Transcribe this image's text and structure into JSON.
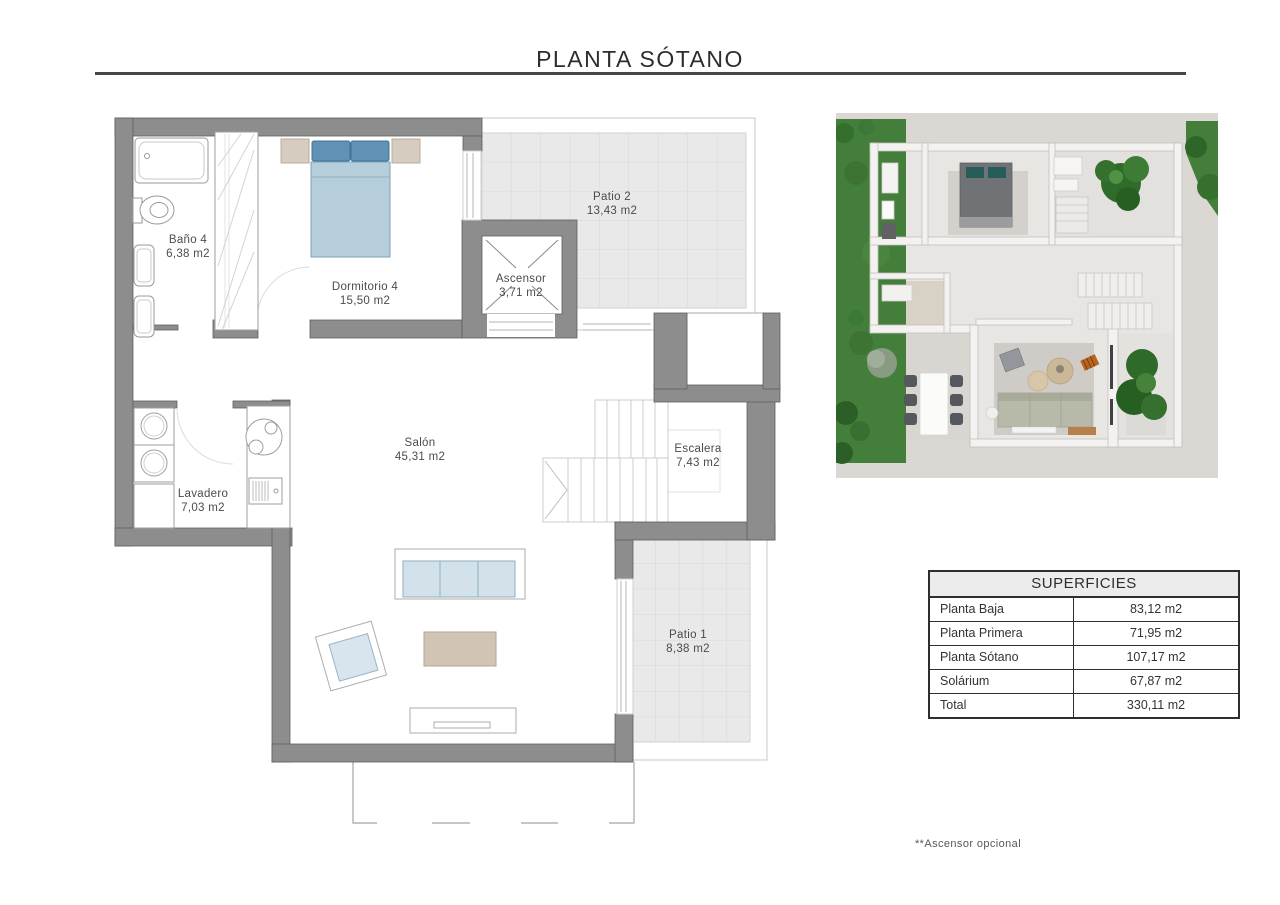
{
  "title": "PLANTA SÓTANO",
  "floor_plan": {
    "rooms": [
      {
        "name": "Baño 4",
        "area": "6,38 m2"
      },
      {
        "name": "Dormitorio 4",
        "area": "15,50 m2"
      },
      {
        "name": "Ascensor",
        "area": "3,71 m2"
      },
      {
        "name": "Patio 2",
        "area": "13,43 m2"
      },
      {
        "name": "Salón",
        "area": "45,31 m2"
      },
      {
        "name": "Escalera",
        "area": "7,43 m2"
      },
      {
        "name": "Lavadero",
        "area": "7,03 m2"
      },
      {
        "name": "Patio 1",
        "area": "8,38 m2"
      }
    ]
  },
  "table": {
    "header": "SUPERFICIES",
    "rows": [
      {
        "label": "Planta Baja",
        "value": "83,12 m2"
      },
      {
        "label": "Planta Primera",
        "value": "71,95 m2"
      },
      {
        "label": "Planta Sótano",
        "value": "107,17 m2"
      },
      {
        "label": "Solárium",
        "value": "67,87 m2"
      },
      {
        "label": "Total",
        "value": "330,11 m2"
      }
    ]
  },
  "footnote": "**Ascensor opcional",
  "colors": {
    "wall_gray": "#8d8d8d",
    "tile_gray": "#e9e9e9",
    "bed_pillow_blue": "#6191b4",
    "bed_body_blue": "#b6cddb",
    "nightstand_tan": "#d6cdc0",
    "coffee_table_tan": "#d2c4b4",
    "sofa_cushion_blue": "#d3e1eb",
    "grass_green": "#447e3b",
    "table_border": "#2e2e2e"
  }
}
